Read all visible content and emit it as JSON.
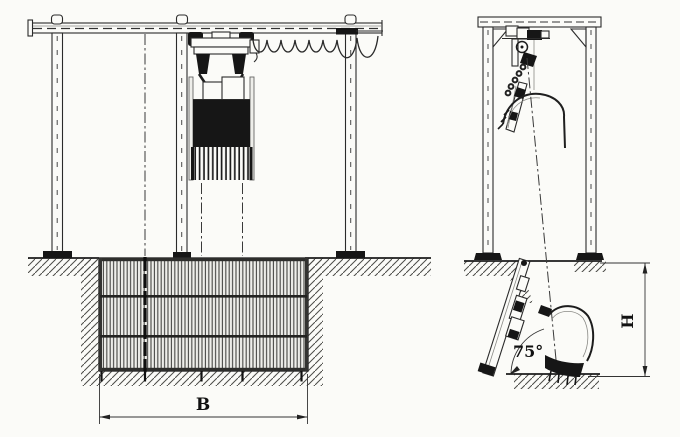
{
  "labels": {
    "dimension_b": "B",
    "dimension_h": "H",
    "screen_angle": "75°"
  },
  "colors": {
    "ink": "#2b2b2b",
    "paper": "#fbfbf8",
    "dark_fill": "#161616"
  }
}
